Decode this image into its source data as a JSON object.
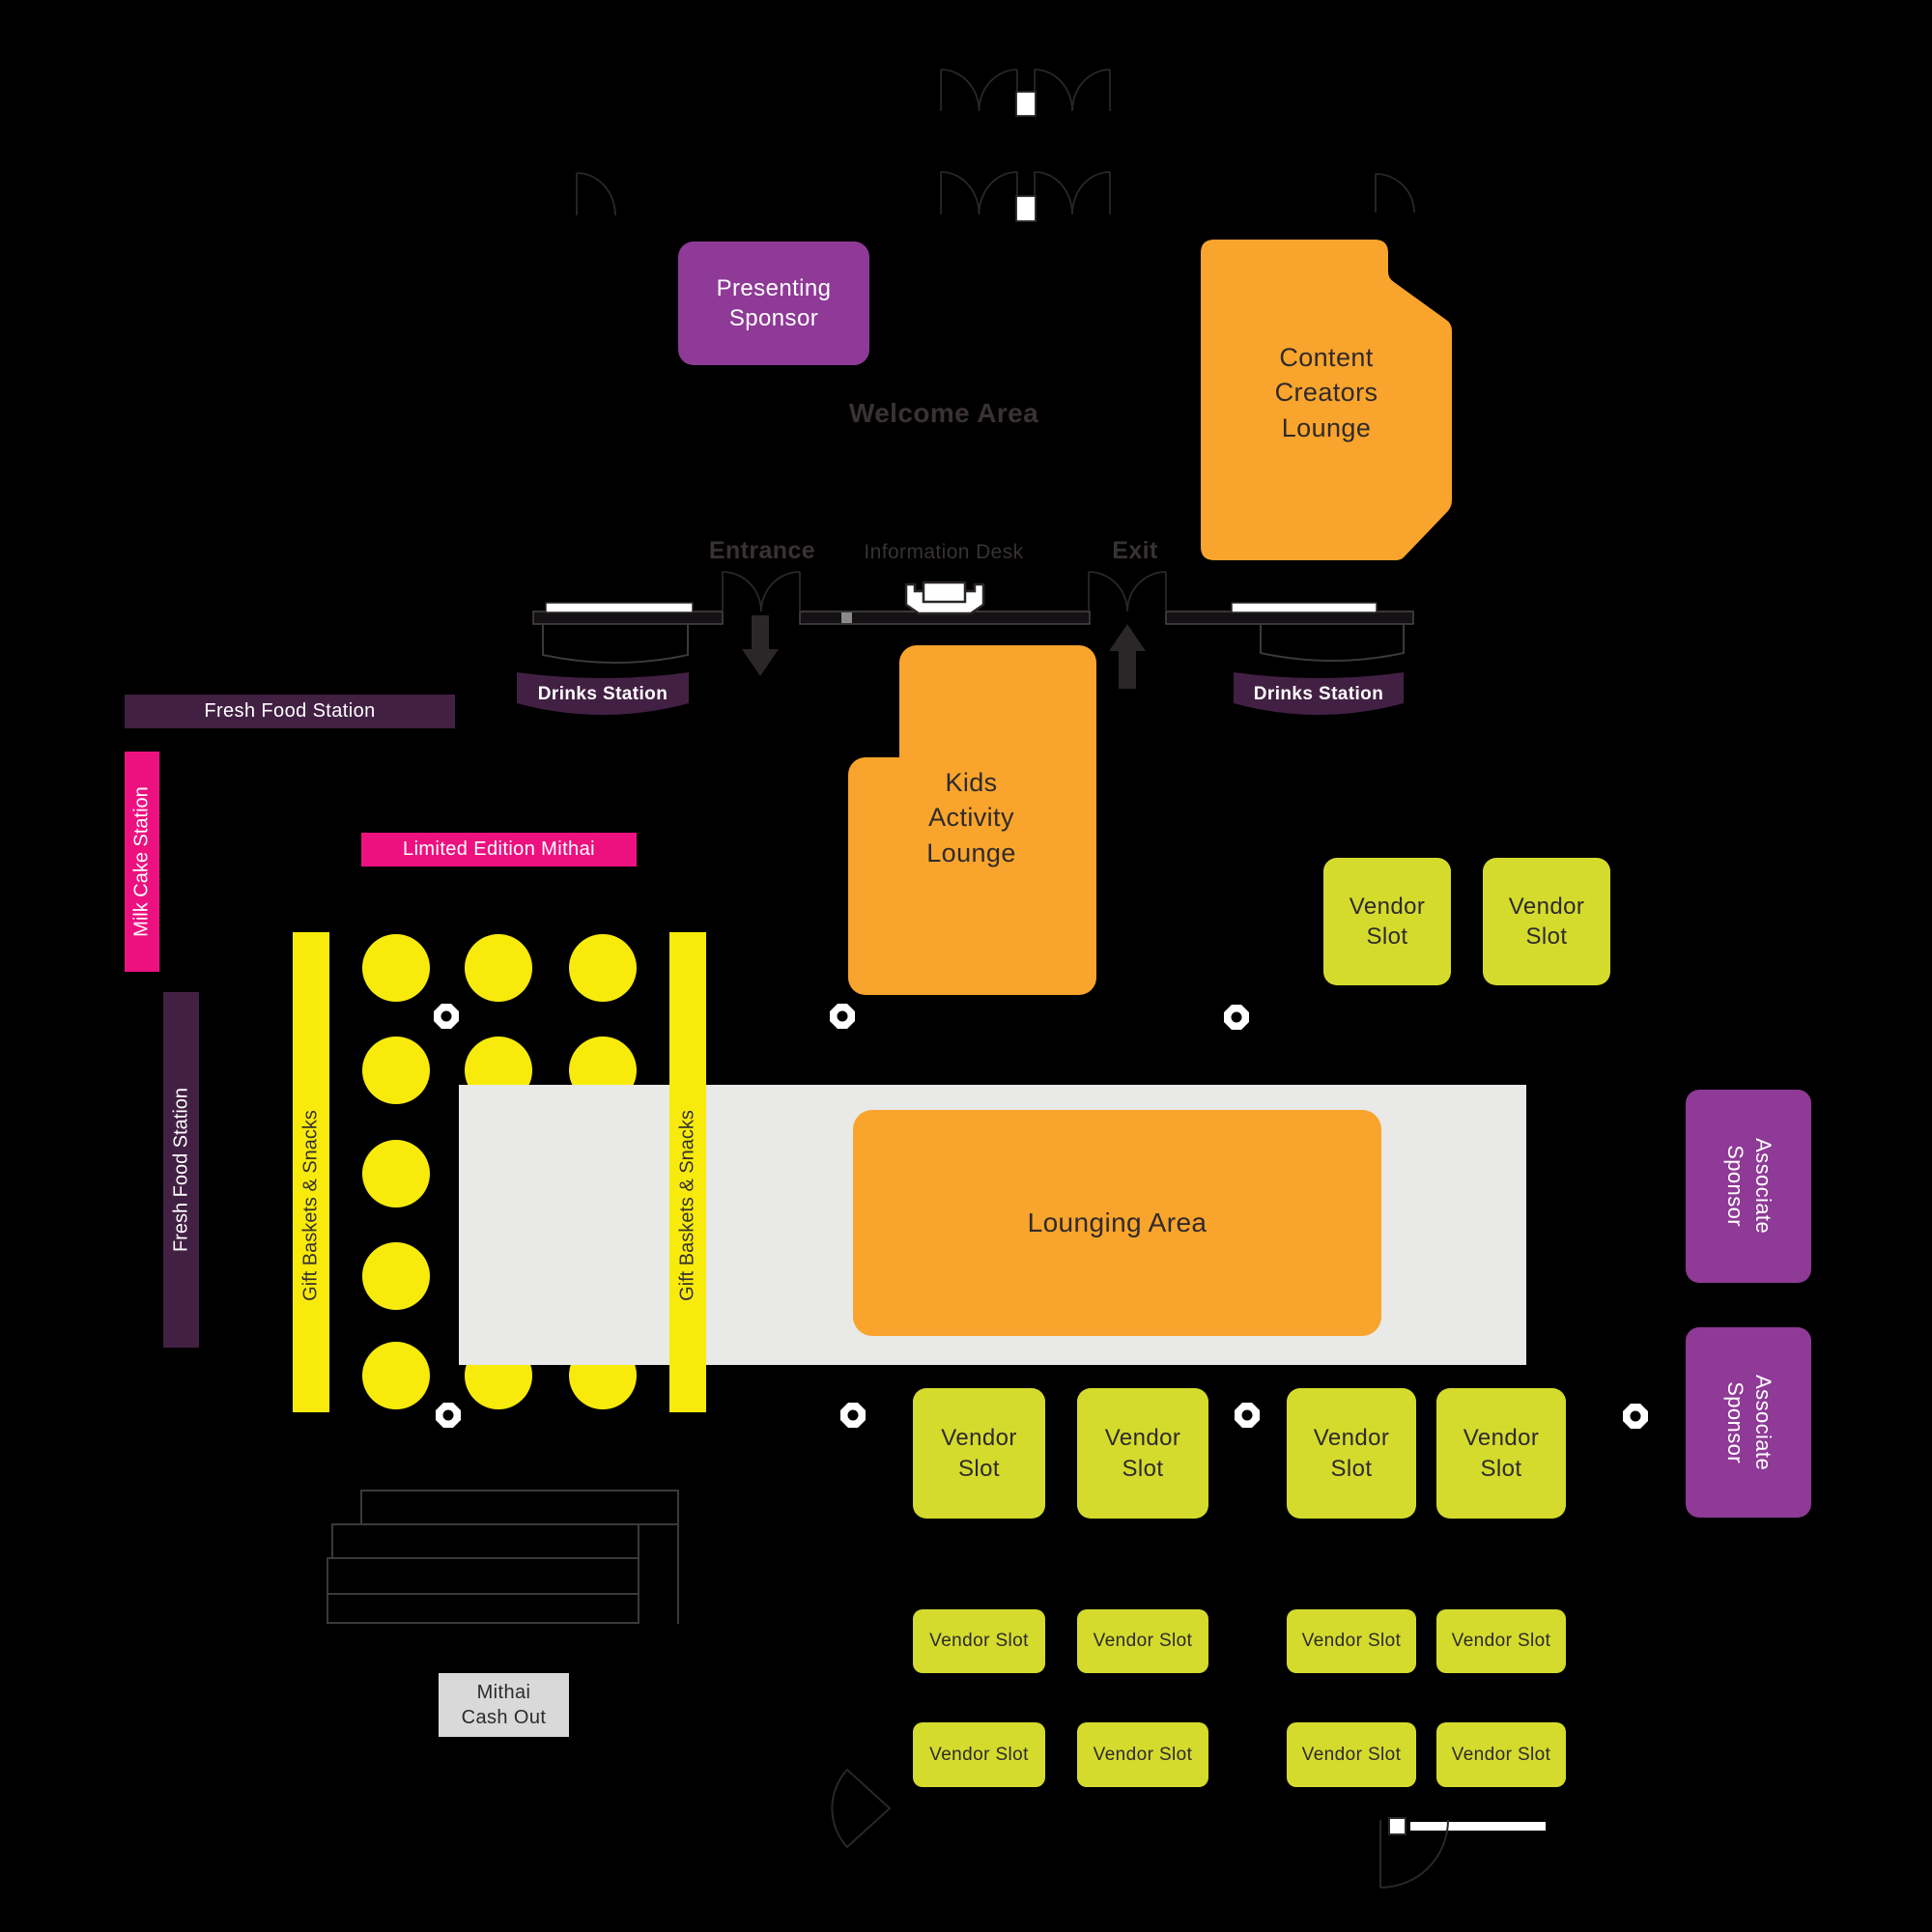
{
  "map": {
    "welcome_area": "Welcome Area",
    "entrance": "Entrance",
    "exit": "Exit",
    "information_desk": "Information Desk"
  },
  "rooms": {
    "presenting_sponsor": "Presenting\nSponsor",
    "content_creators_lounge": "Content\nCreators\nLounge",
    "kids_activity_lounge": "Kids\nActivity\nLounge",
    "lounging_area": "Lounging Area"
  },
  "stations": {
    "fresh_food_horizontal": "Fresh Food Station",
    "fresh_food_vertical": "Fresh Food Station",
    "milk_cake": "Milk Cake Station",
    "limited_edition_mithai": "Limited Edition Mithai",
    "drinks_left": "Drinks Station",
    "drinks_right": "Drinks Station",
    "gift_baskets_left": "Gift Baskets & Snacks",
    "gift_baskets_right": "Gift Baskets & Snacks",
    "mithai_cash_out": "Mithai\nCash Out"
  },
  "vendor_slots": {
    "large": [
      "Vendor\nSlot",
      "Vendor\nSlot",
      "Vendor\nSlot",
      "Vendor\nSlot",
      "Vendor\nSlot",
      "Vendor\nSlot"
    ],
    "small": [
      "Vendor Slot",
      "Vendor Slot",
      "Vendor Slot",
      "Vendor Slot",
      "Vendor Slot",
      "Vendor Slot",
      "Vendor Slot",
      "Vendor Slot"
    ]
  },
  "sponsors": {
    "associate_1": "Associate\nSponsor",
    "associate_2": "Associate\nSponsor"
  },
  "colors": {
    "background": "#000000",
    "sponsor_purple": "#8E3A96",
    "lounge_orange": "#F9A42C",
    "table_yellow": "#F8EB0B",
    "vendor_lime": "#D4DB2D",
    "station_pink": "#ED1180",
    "station_plum": "#422043",
    "platform_gray": "#E9E9E7",
    "cashout_gray": "#D9D9D9",
    "line_ink": "#2B2627",
    "label_gray": "#383234"
  }
}
